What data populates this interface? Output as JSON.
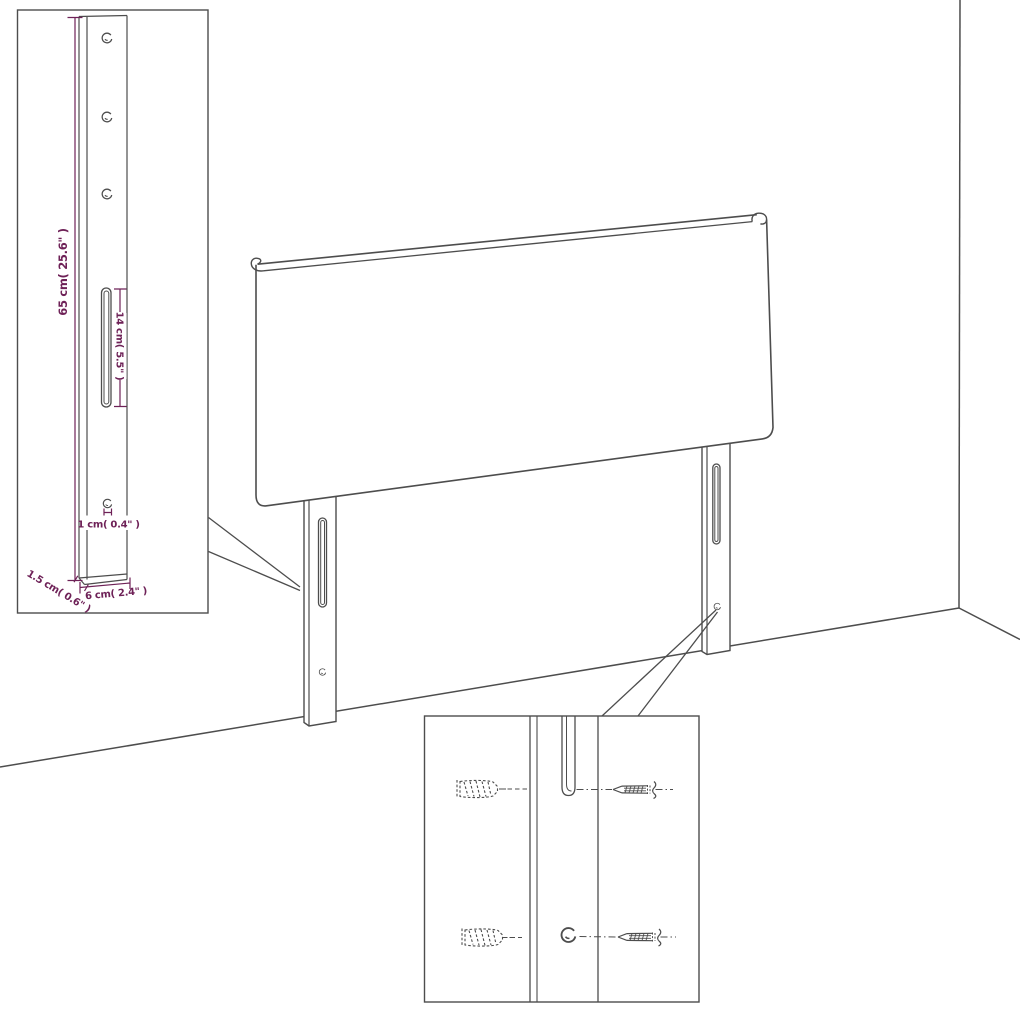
{
  "page": {
    "background": "#ffffff",
    "description": "Line-art assembly diagram of an upholstered headboard with two mounting legs shown against a room corner, with a leg-dimension inset (top-left) and a wall-mounting hardware inset (bottom-right)"
  },
  "colors": {
    "drawing_line": "#4d4d4d",
    "dimension_line": "#6e2157",
    "dimension_text": "#6e2157"
  },
  "leg_detail_inset": {
    "dim_height": "65 cm( 25.6\" )",
    "dim_slot": "14 cm( 5.5\" )",
    "dim_hole": "1 cm( 0.4\" )",
    "dim_thickness": "1.5 cm( 0.6\" )",
    "dim_width": "6 cm( 2.4\" )"
  },
  "mounting_detail_inset": {
    "icons": [
      "wall-plug-icon",
      "screw-icon",
      "leg-slot-icon",
      "pilot-hole-icon"
    ]
  }
}
